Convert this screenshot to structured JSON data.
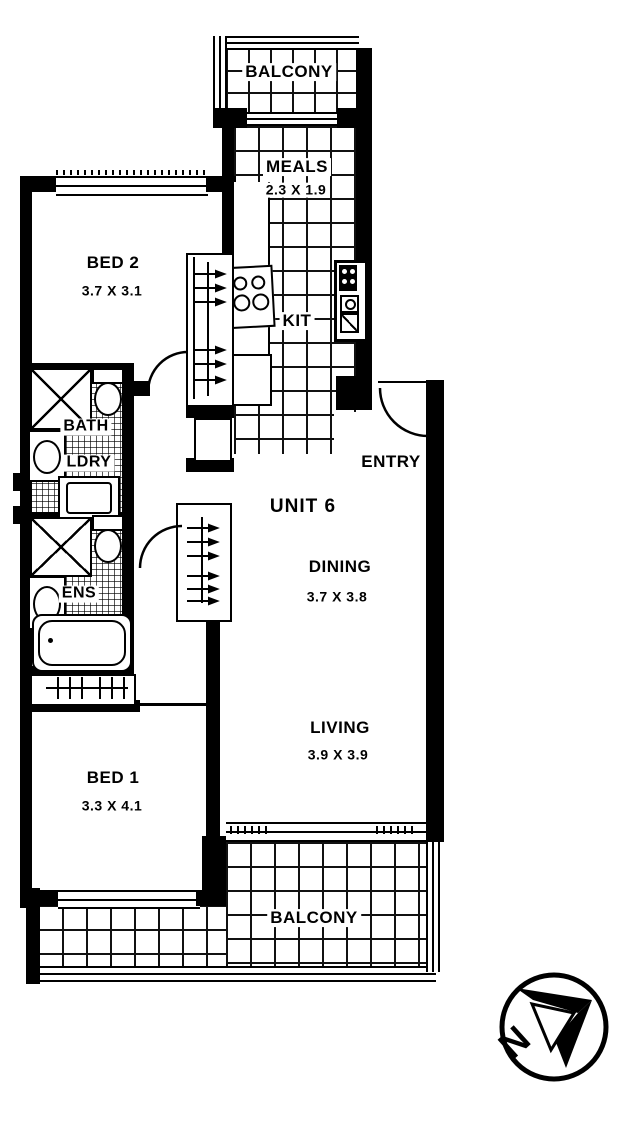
{
  "unit": {
    "label": "UNIT 6"
  },
  "rooms": {
    "balcony_top": {
      "label": "BALCONY"
    },
    "meals": {
      "label": "MEALS",
      "dims": "2.3 X 1.9"
    },
    "bed2": {
      "label": "BED 2",
      "dims": "3.7 X 3.1"
    },
    "kit": {
      "label": "KIT"
    },
    "bath": {
      "label": "BATH"
    },
    "ldry": {
      "label": "LDRY"
    },
    "entry": {
      "label": "ENTRY"
    },
    "dining": {
      "label": "DINING",
      "dims": "3.7 X 3.8"
    },
    "ens": {
      "label": "ENS"
    },
    "living": {
      "label": "LIVING",
      "dims": "3.9 X 3.9"
    },
    "bed1": {
      "label": "BED 1",
      "dims": "3.3 X 4.1"
    },
    "balcony_bottom": {
      "label": "BALCONY"
    }
  },
  "compass": {
    "north_label": "N"
  },
  "colors": {
    "ink": "#000000",
    "paper": "#ffffff"
  }
}
